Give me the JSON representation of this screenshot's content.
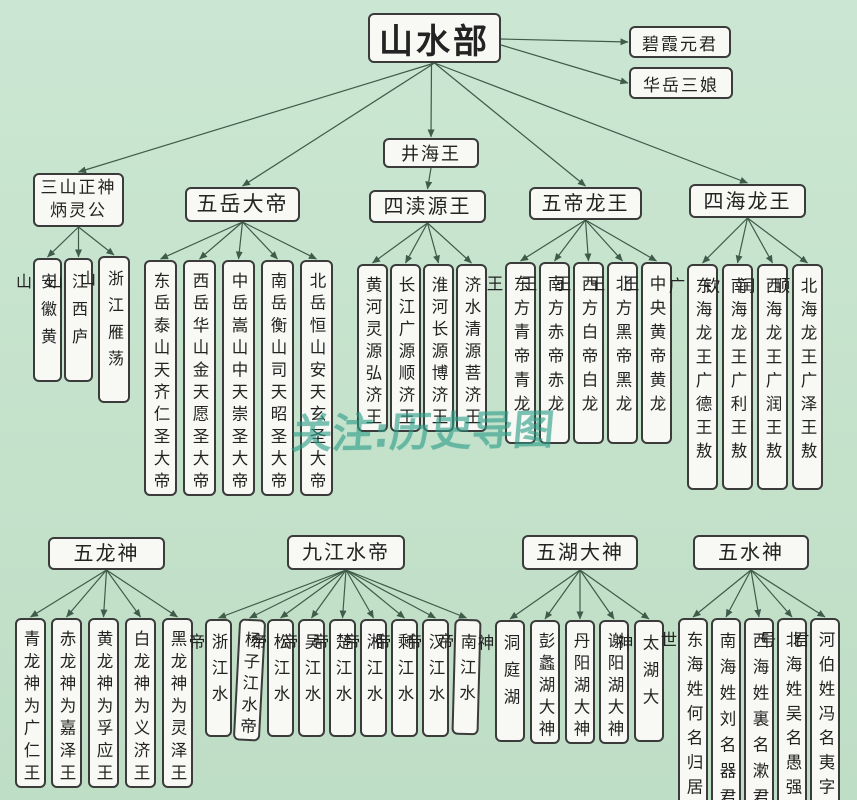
{
  "title": "山水部",
  "annex_nodes": [
    {
      "label": "碧霞元君"
    },
    {
      "label": "华岳三娘"
    }
  ],
  "mid_node": {
    "label": "井海王"
  },
  "top_groups": [
    {
      "id": "sanshan",
      "header_lines": [
        "三山正神",
        "炳灵公"
      ],
      "children": [
        "安徽黄山",
        "江西庐山",
        "浙江雁荡山"
      ]
    },
    {
      "id": "wuyue",
      "header_lines": [
        "五岳大帝"
      ],
      "children": [
        "东岳泰山天齐仁圣大帝",
        "西岳华山金天愿圣大帝",
        "中岳嵩山中天崇圣大帝",
        "南岳衡山司天昭圣大帝",
        "北岳恒山安天玄圣大帝"
      ]
    },
    {
      "id": "sidu",
      "header_lines": [
        "四渎源王"
      ],
      "children": [
        "黄河灵源弘济王",
        "长江广源顺济王",
        "淮河长源博济王",
        "济水清源菩济王"
      ]
    },
    {
      "id": "wudi",
      "header_lines": [
        "五帝龙王"
      ],
      "children": [
        "东方青帝青龙王",
        "南方赤帝赤龙王",
        "西方白帝白龙王",
        "北方黑帝黑龙王",
        "中央黄帝黄龙王"
      ]
    },
    {
      "id": "sihai",
      "header_lines": [
        "四海龙王"
      ],
      "children": [
        "东海龙王广德王敖广",
        "南海龙王广利王敖钦",
        "西海龙王广润王敖闰",
        "北海龙王广泽王敖顺"
      ]
    }
  ],
  "bottom_groups": [
    {
      "id": "wulong",
      "header_lines": [
        "五龙神"
      ],
      "children": [
        "青龙神为广仁王",
        "赤龙神为嘉泽王",
        "黄龙神为孚应王",
        "白龙神为义济王",
        "黑龙神为灵泽王"
      ]
    },
    {
      "id": "jiujiang",
      "header_lines": [
        "九江水帝"
      ],
      "children": [
        "浙江水帝",
        "杨子江水帝",
        "松江水帝",
        "吴江水帝",
        "楚江水帝",
        "湘江水帝",
        "剩江水帝",
        "汉江水帝",
        "南江水帝"
      ]
    },
    {
      "id": "wuhu",
      "header_lines": [
        "五湖大神"
      ],
      "children": [
        "洞庭湖神",
        "彭蠡湖大神",
        "丹阳湖大神",
        "谢阳湖大神",
        "太湖大神"
      ]
    },
    {
      "id": "wushui",
      "header_lines": [
        "五水神"
      ],
      "children": [
        "东海姓何名归居世",
        "南海姓刘名器君",
        "西海姓裏名漱君",
        "北海姓吴名愚强号",
        "河伯姓冯名夷字君"
      ]
    }
  ],
  "watermark": {
    "text": "关注:历史导图"
  },
  "colors": {
    "background": "#c6e3cd",
    "box_fill": "#f8f9f4",
    "box_border": "#3b3b3b",
    "line": "#3f5b49",
    "text": "#232323",
    "watermark": "#2e9e89"
  }
}
